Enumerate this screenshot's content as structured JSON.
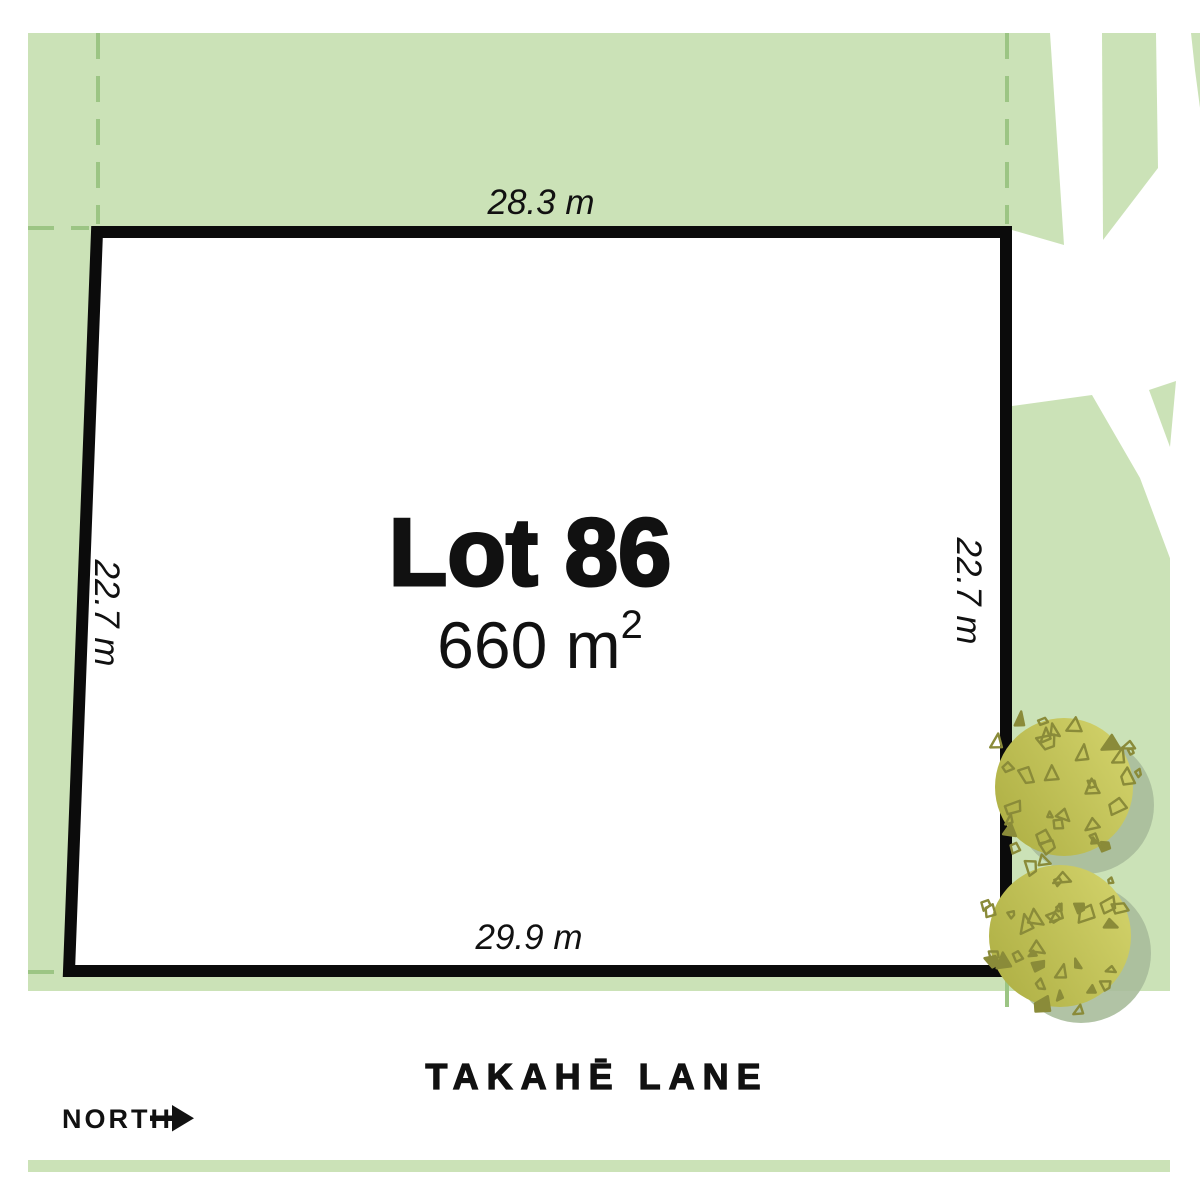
{
  "plan": {
    "lot": {
      "name": "Lot 86",
      "area_main": "660 m",
      "area_exponent": "2",
      "dim_top": "28.3 m",
      "dim_bottom": "29.9 m",
      "dim_left": "22.7 m",
      "dim_right": "22.7 m"
    },
    "street": {
      "name": "TAKAHĒ LANE"
    },
    "compass": {
      "label": "NORTH",
      "direction": "right"
    },
    "icons": {
      "north_arrow": "right-arrow-icon",
      "trees": "tree-canopy-icon"
    },
    "colors": {
      "map_green": "#cbe2b7",
      "dash_green": "#9cc584",
      "road_white": "#ffffff",
      "lot_fill": "#ffffff",
      "lot_border": "#0b0b0b",
      "text_black": "#111111",
      "tree_dark": "#afb045",
      "tree_light": "#d2d26a",
      "tree_speck": "#8a8b39",
      "tree_shadow": "#a9bd9b"
    }
  }
}
